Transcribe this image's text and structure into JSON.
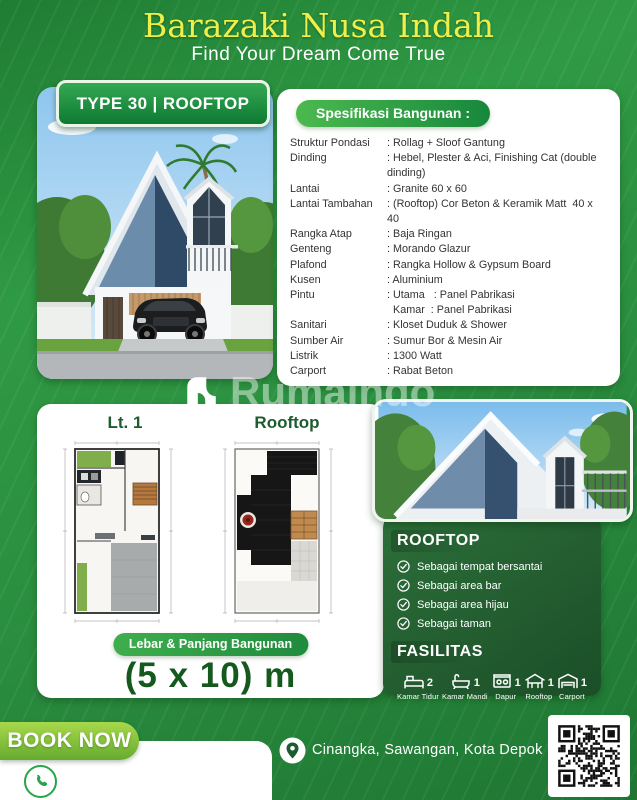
{
  "header": {
    "title": "Barazaki Nusa Indah",
    "subtitle": "Find Your Dream Come True"
  },
  "type_badge": "TYPE 30 | ROOFTOP",
  "specs": {
    "heading": "Spesifikasi Bangunan :",
    "rows": [
      {
        "label": "Struktur Pondasi",
        "value": ": Rollag + Sloof Gantung"
      },
      {
        "label": "Dinding",
        "value": ": Hebel, Plester & Aci, Finishing Cat (double dinding)"
      },
      {
        "label": "Lantai",
        "value": ": Granite 60 x 60"
      },
      {
        "label": "Lantai Tambahan",
        "value": ": (Rooftop) Cor Beton & Keramik Matt  40 x 40"
      },
      {
        "label": "Rangka Atap",
        "value": ": Baja Ringan"
      },
      {
        "label": "Genteng",
        "value": ": Morando Glazur"
      },
      {
        "label": "Plafond",
        "value": ": Rangka Hollow & Gypsum Board"
      },
      {
        "label": "Kusen",
        "value": ": Aluminium"
      },
      {
        "label": "Pintu",
        "value": ": Utama   : Panel Pabrikasi"
      },
      {
        "label": "",
        "value": "  Kamar  : Panel Pabrikasi"
      },
      {
        "label": "Sanitari",
        "value": ": Kloset Duduk & Shower"
      },
      {
        "label": "Sumber Air",
        "value": ": Sumur Bor & Mesin Air"
      },
      {
        "label": "Listrik",
        "value": ": 1300 Watt"
      },
      {
        "label": "Carport",
        "value": ": Rabat Beton"
      }
    ]
  },
  "watermark": "Rumaindo",
  "plans": {
    "floor1_label": "Lt. 1",
    "rooftop_label": "Rooftop",
    "size_pill": "Lebar & Panjang Bangunan",
    "size_value": "(5 x 10) m"
  },
  "rooftop_panel": {
    "heading": "ROOFTOP",
    "items": [
      "Sebagai tempat bersantai",
      "Sebagai area bar",
      "Sebagai area hijau",
      "Sebagai taman"
    ]
  },
  "fasilitas": {
    "heading": "FASILITAS",
    "items": [
      {
        "icon": "bed-icon",
        "count": "2",
        "label": "Kamar Tidur"
      },
      {
        "icon": "bath-icon",
        "count": "1",
        "label": "Kamar Mandi"
      },
      {
        "icon": "kitchen-icon",
        "count": "1",
        "label": "Dapur"
      },
      {
        "icon": "rooftop-icon",
        "count": "1",
        "label": "Rooftop"
      },
      {
        "icon": "carport-icon",
        "count": "1",
        "label": "Carport"
      }
    ]
  },
  "footer": {
    "book_now": "BOOK NOW",
    "location": "Cinangka, Sawangan, Kota Depok"
  },
  "colors": {
    "brand_green": "#2e9345",
    "dark_panel_green": "#1e5b2d",
    "title_yellow": "#f0ee4a",
    "book_now_green": "#8cc63e"
  }
}
